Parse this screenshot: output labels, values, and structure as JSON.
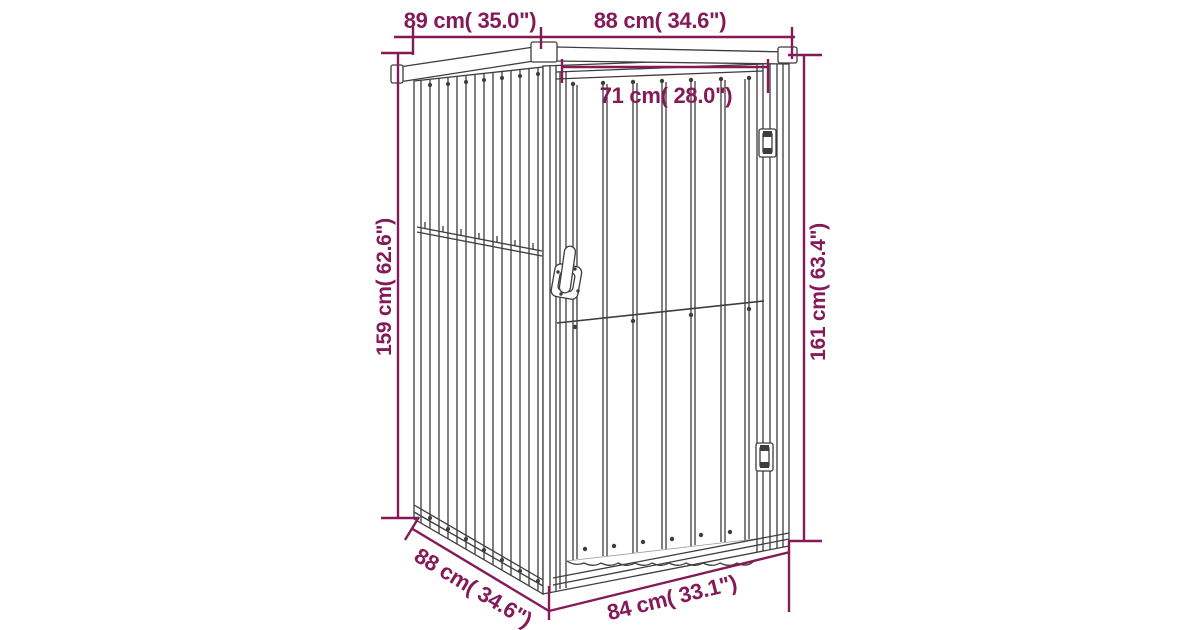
{
  "labels": {
    "roof_depth": "89 cm( 35.0\")",
    "roof_width": "88 cm( 34.6\")",
    "door_width": "71 cm( 28.0\")",
    "side_height": "159 cm( 62.6\")",
    "front_height": "161 cm( 63.4\")",
    "base_depth": "88 cm( 34.6\")",
    "base_width": "84 cm( 33.1\")"
  },
  "colors": {
    "dimension": "#851A58",
    "line_art": "#3D3D3D",
    "background": "#FFFFFF"
  }
}
